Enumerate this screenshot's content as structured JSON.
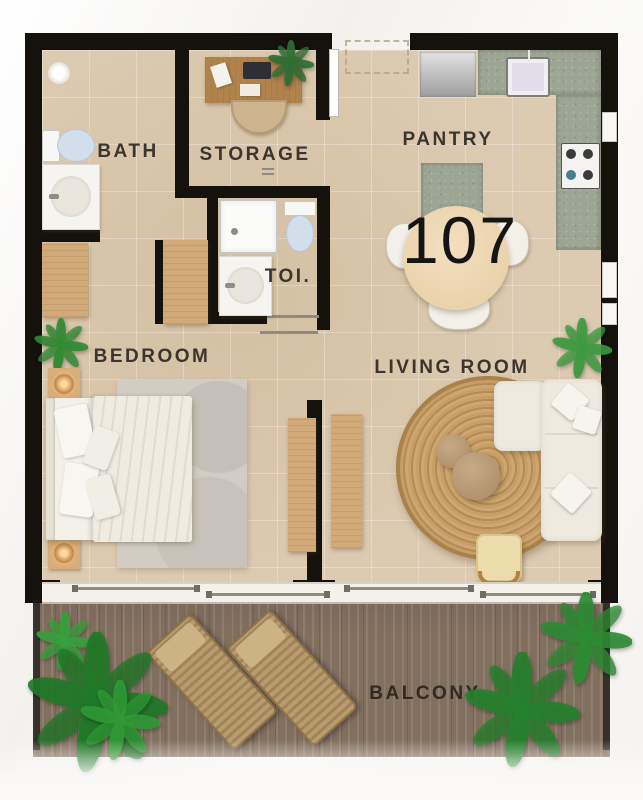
{
  "floorplan": {
    "unit_number": "107",
    "rooms": {
      "bath": {
        "label": "BATH"
      },
      "storage": {
        "label": "STORAGE"
      },
      "pantry": {
        "label": "PANTRY"
      },
      "toilet": {
        "label": "TOI."
      },
      "bedroom": {
        "label": "BEDROOM"
      },
      "living_room": {
        "label": "LIVING ROOM"
      },
      "balcony": {
        "label": "BALCONY"
      }
    },
    "palette": {
      "wall_black": "#15120e",
      "floor_tile_beige": "#dccbb1",
      "balcony_wood_brown": "#82705f",
      "kitchen_counter_concrete": "#9da594",
      "wood_furniture": "#d2a978",
      "rattan_rug": "#c79e66",
      "sofa_cream": "#efeadf",
      "label_text": "#3a352d",
      "plant_green": "#3c9a3f",
      "lamp_glow": "#ffd9a0"
    }
  }
}
